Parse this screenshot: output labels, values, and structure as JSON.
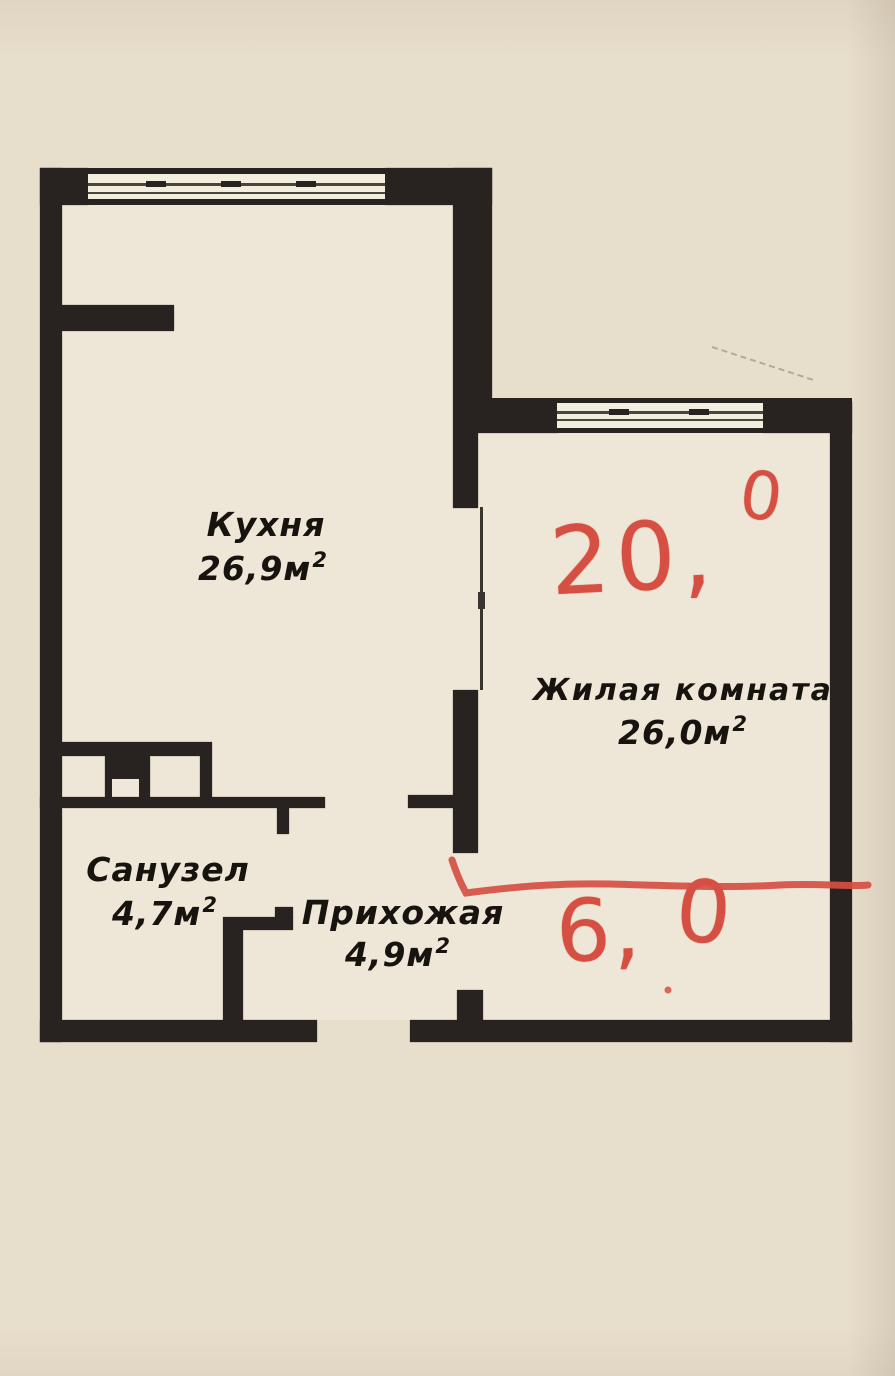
{
  "document": {
    "kind": "apartment floor plan scan",
    "language": "ru"
  },
  "rooms": [
    {
      "id": "kitchen",
      "name": "Кухня",
      "area": "26,9м²",
      "area_main": "26,9м",
      "area_sup": "2"
    },
    {
      "id": "living-room",
      "name": "Жилая комната",
      "area": "26,0м²",
      "area_main": "26,0м",
      "area_sup": "2"
    },
    {
      "id": "bathroom",
      "name": "Санузел",
      "area": "4,7м²",
      "area_main": "4,7м",
      "area_sup": "2"
    },
    {
      "id": "hallway",
      "name": "Прихожая",
      "area": "4,9м²",
      "area_main": "4,9м",
      "area_sup": "2"
    }
  ],
  "annotations": {
    "living_room_marked": {
      "full": "20,0",
      "main": "20,",
      "sup": "0"
    },
    "hallway_marked": {
      "full": "6,0",
      "main": "6,",
      "tail": "0"
    }
  },
  "colors": {
    "paper": "#e8decc",
    "room_fill": "#eee6d6",
    "wall": "#282320",
    "annotation_red": "#d64f43",
    "pencil_mark": "#7d7564"
  }
}
